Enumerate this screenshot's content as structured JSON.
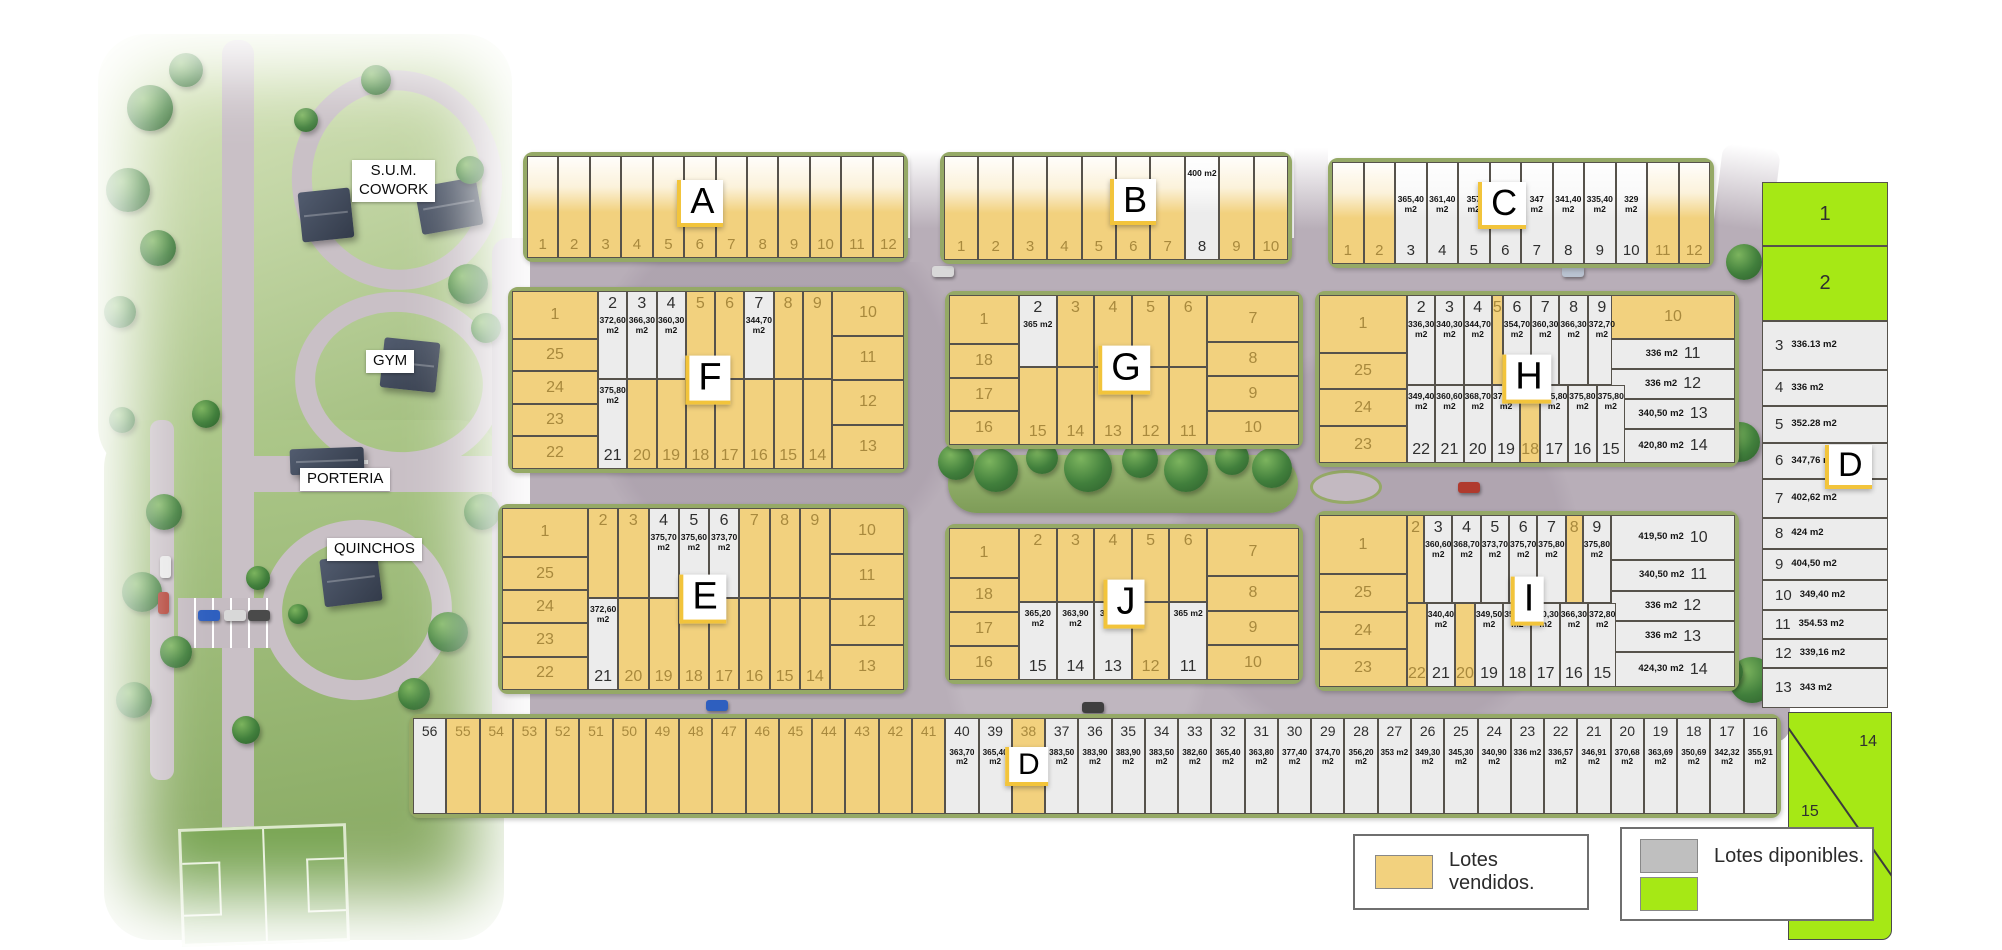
{
  "legend": {
    "sold_label": "Lotes vendidos.",
    "available_label": "Lotes diponibles."
  },
  "colors": {
    "sold": "#F2D17E",
    "available": "#ECECEC",
    "available_green": "#A6E815",
    "rim": "#95A966",
    "road": "#B8AEB8"
  },
  "site_labels": {
    "sum_cowork": "S.U.M.\nCOWORK",
    "gym": "GYM",
    "porteria": "PORTERIA",
    "quinchos": "QUINCHOS"
  },
  "blocks": [
    {
      "id": "A",
      "label": "A",
      "lots": [
        {
          "n": "1",
          "s": "sold"
        },
        {
          "n": "2",
          "s": "sold"
        },
        {
          "n": "3",
          "s": "sold"
        },
        {
          "n": "4",
          "s": "sold"
        },
        {
          "n": "5",
          "s": "sold"
        },
        {
          "n": "6",
          "s": "sold"
        },
        {
          "n": "7",
          "s": "sold"
        },
        {
          "n": "8",
          "s": "sold"
        },
        {
          "n": "9",
          "s": "sold"
        },
        {
          "n": "10",
          "s": "sold"
        },
        {
          "n": "11",
          "s": "sold"
        },
        {
          "n": "12",
          "s": "sold"
        }
      ]
    },
    {
      "id": "B",
      "label": "B",
      "lots": [
        {
          "n": "1",
          "s": "sold"
        },
        {
          "n": "2",
          "s": "sold"
        },
        {
          "n": "3",
          "s": "sold"
        },
        {
          "n": "4",
          "s": "sold"
        },
        {
          "n": "5",
          "s": "sold"
        },
        {
          "n": "6",
          "s": "sold"
        },
        {
          "n": "7",
          "s": "sold"
        },
        {
          "n": "8",
          "s": "avail",
          "area": "400 m2"
        },
        {
          "n": "9",
          "s": "sold"
        },
        {
          "n": "10",
          "s": "sold"
        }
      ]
    },
    {
      "id": "C",
      "label": "C",
      "lots": [
        {
          "n": "1",
          "s": "sold"
        },
        {
          "n": "2",
          "s": "sold"
        },
        {
          "n": "3",
          "s": "avail",
          "area": "365,40 m2"
        },
        {
          "n": "4",
          "s": "avail",
          "area": "361,40 m2"
        },
        {
          "n": "5",
          "s": "avail",
          "area": "357 m2"
        },
        {
          "n": "6",
          "s": "avail",
          "area": "352,20 m2"
        },
        {
          "n": "7",
          "s": "avail",
          "area": "347 m2"
        },
        {
          "n": "8",
          "s": "avail",
          "area": "341,40 m2"
        },
        {
          "n": "9",
          "s": "avail",
          "area": "335,40 m2"
        },
        {
          "n": "10",
          "s": "avail",
          "area": "329 m2"
        },
        {
          "n": "11",
          "s": "sold"
        },
        {
          "n": "12",
          "s": "sold"
        }
      ]
    },
    {
      "id": "F",
      "label": "F",
      "left": [
        {
          "n": "1",
          "s": "sold"
        },
        {
          "n": "25",
          "s": "sold"
        },
        {
          "n": "24",
          "s": "sold"
        },
        {
          "n": "23",
          "s": "sold"
        },
        {
          "n": "22",
          "s": "sold"
        }
      ],
      "top": [
        {
          "n": "2",
          "s": "avail",
          "area": "372,60 m2"
        },
        {
          "n": "3",
          "s": "avail",
          "area": "366,30 m2"
        },
        {
          "n": "4",
          "s": "avail",
          "area": "360,30 m2"
        },
        {
          "n": "5",
          "s": "sold"
        },
        {
          "n": "6",
          "s": "sold"
        },
        {
          "n": "7",
          "s": "avail",
          "area": "344,70 m2"
        },
        {
          "n": "8",
          "s": "sold"
        },
        {
          "n": "9",
          "s": "sold"
        }
      ],
      "right": [
        {
          "n": "10",
          "s": "sold"
        },
        {
          "n": "11",
          "s": "sold"
        },
        {
          "n": "12",
          "s": "sold"
        },
        {
          "n": "13",
          "s": "sold"
        }
      ],
      "bottom": [
        {
          "n": "21",
          "s": "avail",
          "area": "375,80 m2"
        },
        {
          "n": "20",
          "s": "sold"
        },
        {
          "n": "19",
          "s": "sold"
        },
        {
          "n": "18",
          "s": "sold"
        },
        {
          "n": "17",
          "s": "sold"
        },
        {
          "n": "16",
          "s": "sold"
        },
        {
          "n": "15",
          "s": "sold"
        },
        {
          "n": "14",
          "s": "sold"
        }
      ]
    },
    {
      "id": "G",
      "label": "G",
      "left": [
        {
          "n": "1",
          "s": "sold"
        },
        {
          "n": "18",
          "s": "sold"
        },
        {
          "n": "17",
          "s": "sold"
        },
        {
          "n": "16",
          "s": "sold"
        }
      ],
      "top": [
        {
          "n": "2",
          "s": "avail",
          "area": "365 m2"
        },
        {
          "n": "3",
          "s": "sold"
        },
        {
          "n": "4",
          "s": "sold"
        },
        {
          "n": "5",
          "s": "sold"
        },
        {
          "n": "6",
          "s": "sold"
        }
      ],
      "right": [
        {
          "n": "7",
          "s": "sold"
        },
        {
          "n": "8",
          "s": "sold"
        },
        {
          "n": "9",
          "s": "sold"
        },
        {
          "n": "10",
          "s": "sold"
        }
      ],
      "bottom": [
        {
          "n": "15",
          "s": "sold"
        },
        {
          "n": "14",
          "s": "sold"
        },
        {
          "n": "13",
          "s": "sold"
        },
        {
          "n": "12",
          "s": "sold"
        },
        {
          "n": "11",
          "s": "sold"
        }
      ]
    },
    {
      "id": "H",
      "label": "H",
      "left": [
        {
          "n": "1",
          "s": "sold"
        },
        {
          "n": "25",
          "s": "sold"
        },
        {
          "n": "24",
          "s": "sold"
        },
        {
          "n": "23",
          "s": "sold"
        }
      ],
      "top": [
        {
          "n": "2",
          "s": "avail",
          "area": "336,30 m2"
        },
        {
          "n": "3",
          "s": "avail",
          "area": "340,30 m2"
        },
        {
          "n": "4",
          "s": "avail",
          "area": "344,70 m2"
        },
        {
          "n": "5",
          "s": "sold"
        },
        {
          "n": "6",
          "s": "avail",
          "area": "354,70 m2"
        },
        {
          "n": "7",
          "s": "avail",
          "area": "360,30 m2"
        },
        {
          "n": "8",
          "s": "avail",
          "area": "366,30 m2"
        },
        {
          "n": "9",
          "s": "avail",
          "area": "372,70 m2"
        }
      ],
      "right": [
        {
          "n": "10",
          "s": "sold"
        },
        {
          "n": "11",
          "s": "avail",
          "area": "336 m2"
        },
        {
          "n": "12",
          "s": "avail",
          "area": "336 m2"
        },
        {
          "n": "13",
          "s": "avail",
          "area": "340,50 m2"
        },
        {
          "n": "14",
          "s": "avail",
          "area": "420,80 m2"
        }
      ],
      "bottom": [
        {
          "n": "22",
          "s": "avail",
          "area": "349,40 m2"
        },
        {
          "n": "21",
          "s": "avail",
          "area": "360,60 m2"
        },
        {
          "n": "20",
          "s": "avail",
          "area": "368,70 m2"
        },
        {
          "n": "19",
          "s": "avail",
          "area": "373,70 m2"
        },
        {
          "n": "18",
          "s": "sold"
        },
        {
          "n": "17",
          "s": "avail",
          "area": "375,80 m2"
        },
        {
          "n": "16",
          "s": "avail",
          "area": "375,80 m2"
        },
        {
          "n": "15",
          "s": "avail",
          "area": "375,80 m2"
        }
      ]
    },
    {
      "id": "E",
      "label": "E",
      "left": [
        {
          "n": "1",
          "s": "sold"
        },
        {
          "n": "25",
          "s": "sold"
        },
        {
          "n": "24",
          "s": "sold"
        },
        {
          "n": "23",
          "s": "sold"
        },
        {
          "n": "22",
          "s": "sold"
        }
      ],
      "top": [
        {
          "n": "2",
          "s": "sold"
        },
        {
          "n": "3",
          "s": "sold"
        },
        {
          "n": "4",
          "s": "avail",
          "area": "375,70 m2"
        },
        {
          "n": "5",
          "s": "avail",
          "area": "375,60 m2"
        },
        {
          "n": "6",
          "s": "avail",
          "area": "373,70 m2"
        },
        {
          "n": "7",
          "s": "sold"
        },
        {
          "n": "8",
          "s": "sold"
        },
        {
          "n": "9",
          "s": "sold"
        }
      ],
      "right": [
        {
          "n": "10",
          "s": "sold"
        },
        {
          "n": "11",
          "s": "sold"
        },
        {
          "n": "12",
          "s": "sold"
        },
        {
          "n": "13",
          "s": "sold"
        }
      ],
      "bottom": [
        {
          "n": "21",
          "s": "avail",
          "area": "372,60 m2"
        },
        {
          "n": "20",
          "s": "sold"
        },
        {
          "n": "19",
          "s": "sold"
        },
        {
          "n": "18",
          "s": "sold"
        },
        {
          "n": "17",
          "s": "sold"
        },
        {
          "n": "16",
          "s": "sold"
        },
        {
          "n": "15",
          "s": "sold"
        },
        {
          "n": "14",
          "s": "sold"
        }
      ]
    },
    {
      "id": "J",
      "label": "J",
      "left": [
        {
          "n": "1",
          "s": "sold"
        },
        {
          "n": "18",
          "s": "sold"
        },
        {
          "n": "17",
          "s": "sold"
        },
        {
          "n": "16",
          "s": "sold"
        }
      ],
      "top": [
        {
          "n": "2",
          "s": "sold"
        },
        {
          "n": "3",
          "s": "sold"
        },
        {
          "n": "4",
          "s": "sold"
        },
        {
          "n": "5",
          "s": "sold"
        },
        {
          "n": "6",
          "s": "sold"
        }
      ],
      "right": [
        {
          "n": "7",
          "s": "sold"
        },
        {
          "n": "8",
          "s": "sold"
        },
        {
          "n": "9",
          "s": "sold"
        },
        {
          "n": "10",
          "s": "sold"
        }
      ],
      "bottom": [
        {
          "n": "15",
          "s": "avail",
          "area": "365,20 m2"
        },
        {
          "n": "14",
          "s": "avail",
          "area": "363,90 m2"
        },
        {
          "n": "13",
          "s": "avail",
          "area": "363,60 m2"
        },
        {
          "n": "12",
          "s": "sold"
        },
        {
          "n": "11",
          "s": "avail",
          "area": "365 m2"
        }
      ]
    },
    {
      "id": "I",
      "label": "I",
      "left": [
        {
          "n": "1",
          "s": "sold"
        },
        {
          "n": "25",
          "s": "sold"
        },
        {
          "n": "24",
          "s": "sold"
        },
        {
          "n": "23",
          "s": "sold"
        }
      ],
      "top": [
        {
          "n": "2",
          "s": "sold"
        },
        {
          "n": "3",
          "s": "avail",
          "area": "360,60 m2"
        },
        {
          "n": "4",
          "s": "avail",
          "area": "368,70 m2"
        },
        {
          "n": "5",
          "s": "avail",
          "area": "373,70 m2"
        },
        {
          "n": "6",
          "s": "avail",
          "area": "375,70 m2"
        },
        {
          "n": "7",
          "s": "avail",
          "area": "375,80 m2"
        },
        {
          "n": "8",
          "s": "sold"
        },
        {
          "n": "9",
          "s": "avail",
          "area": "375,80 m2"
        }
      ],
      "right": [
        {
          "n": "10",
          "s": "avail",
          "area": "419,50 m2"
        },
        {
          "n": "11",
          "s": "avail",
          "area": "340,50 m2"
        },
        {
          "n": "12",
          "s": "avail",
          "area": "336 m2"
        },
        {
          "n": "13",
          "s": "avail",
          "area": "336 m2"
        },
        {
          "n": "14",
          "s": "avail",
          "area": "424,30 m2"
        }
      ],
      "bottom": [
        {
          "n": "22",
          "s": "sold"
        },
        {
          "n": "21",
          "s": "avail",
          "area": "340,40 m2"
        },
        {
          "n": "20",
          "s": "sold"
        },
        {
          "n": "19",
          "s": "avail",
          "area": "349,50 m2"
        },
        {
          "n": "18",
          "s": "avail",
          "area": "354,70 m2"
        },
        {
          "n": "17",
          "s": "avail",
          "area": "360,30 m2"
        },
        {
          "n": "16",
          "s": "avail",
          "area": "366,30 m2"
        },
        {
          "n": "15",
          "s": "avail",
          "area": "372,80 m2"
        }
      ]
    },
    {
      "id": "DE",
      "label": "D",
      "lots": [
        {
          "n": "1",
          "s": "green"
        },
        {
          "n": "2",
          "s": "green"
        },
        {
          "n": "3",
          "s": "avail",
          "area": "336.13 m2"
        },
        {
          "n": "4",
          "s": "avail",
          "area": "336 m2"
        },
        {
          "n": "5",
          "s": "avail",
          "area": "352.28 m2"
        },
        {
          "n": "6",
          "s": "avail",
          "area": "347,76 m2"
        },
        {
          "n": "7",
          "s": "avail",
          "area": "402,62 m2"
        },
        {
          "n": "8",
          "s": "avail",
          "area": "424 m2"
        },
        {
          "n": "9",
          "s": "avail",
          "area": "404,50 m2"
        },
        {
          "n": "10",
          "s": "avail",
          "area": "349,40 m2"
        },
        {
          "n": "11",
          "s": "avail",
          "area": "354.53 m2"
        },
        {
          "n": "12",
          "s": "avail",
          "area": "339,16 m2"
        },
        {
          "n": "13",
          "s": "avail",
          "area": "343 m2"
        }
      ]
    },
    {
      "id": "DS",
      "label": "D",
      "lots": [
        {
          "n": "56",
          "s": "avail"
        },
        {
          "n": "55",
          "s": "sold"
        },
        {
          "n": "54",
          "s": "sold"
        },
        {
          "n": "53",
          "s": "sold"
        },
        {
          "n": "52",
          "s": "sold"
        },
        {
          "n": "51",
          "s": "sold"
        },
        {
          "n": "50",
          "s": "sold"
        },
        {
          "n": "49",
          "s": "sold"
        },
        {
          "n": "48",
          "s": "sold"
        },
        {
          "n": "47",
          "s": "sold"
        },
        {
          "n": "46",
          "s": "sold"
        },
        {
          "n": "45",
          "s": "sold"
        },
        {
          "n": "44",
          "s": "sold"
        },
        {
          "n": "43",
          "s": "sold"
        },
        {
          "n": "42",
          "s": "sold"
        },
        {
          "n": "41",
          "s": "sold"
        },
        {
          "n": "40",
          "s": "avail",
          "area": "363,70 m2"
        },
        {
          "n": "39",
          "s": "avail",
          "area": "365,40 m2"
        },
        {
          "n": "38",
          "s": "sold"
        },
        {
          "n": "37",
          "s": "avail",
          "area": "383,50 m2"
        },
        {
          "n": "36",
          "s": "avail",
          "area": "383,90 m2"
        },
        {
          "n": "35",
          "s": "avail",
          "area": "383,90 m2"
        },
        {
          "n": "34",
          "s": "avail",
          "area": "383,50 m2"
        },
        {
          "n": "33",
          "s": "avail",
          "area": "382,60 m2"
        },
        {
          "n": "32",
          "s": "avail",
          "area": "365,40 m2"
        },
        {
          "n": "31",
          "s": "avail",
          "area": "363,80 m2"
        },
        {
          "n": "30",
          "s": "avail",
          "area": "377,40 m2"
        },
        {
          "n": "29",
          "s": "avail",
          "area": "374,70 m2"
        },
        {
          "n": "28",
          "s": "avail",
          "area": "356,20 m2"
        },
        {
          "n": "27",
          "s": "avail",
          "area": "353 m2"
        },
        {
          "n": "26",
          "s": "avail",
          "area": "349,30 m2"
        },
        {
          "n": "25",
          "s": "avail",
          "area": "345,30 m2"
        },
        {
          "n": "24",
          "s": "avail",
          "area": "340,90 m2"
        },
        {
          "n": "23",
          "s": "avail",
          "area": "336 m2"
        },
        {
          "n": "22",
          "s": "avail",
          "area": "336,57 m2"
        },
        {
          "n": "21",
          "s": "avail",
          "area": "346,91 m2"
        },
        {
          "n": "20",
          "s": "avail",
          "area": "370,68 m2"
        },
        {
          "n": "19",
          "s": "avail",
          "area": "363,69 m2"
        },
        {
          "n": "18",
          "s": "avail",
          "area": "350,69 m2"
        },
        {
          "n": "17",
          "s": "avail",
          "area": "342,32 m2"
        },
        {
          "n": "16",
          "s": "avail",
          "area": "355,91 m2"
        }
      ]
    },
    {
      "id": "DC",
      "lots": [
        {
          "n": "14",
          "s": "green"
        },
        {
          "n": "15",
          "s": "green"
        }
      ]
    }
  ]
}
